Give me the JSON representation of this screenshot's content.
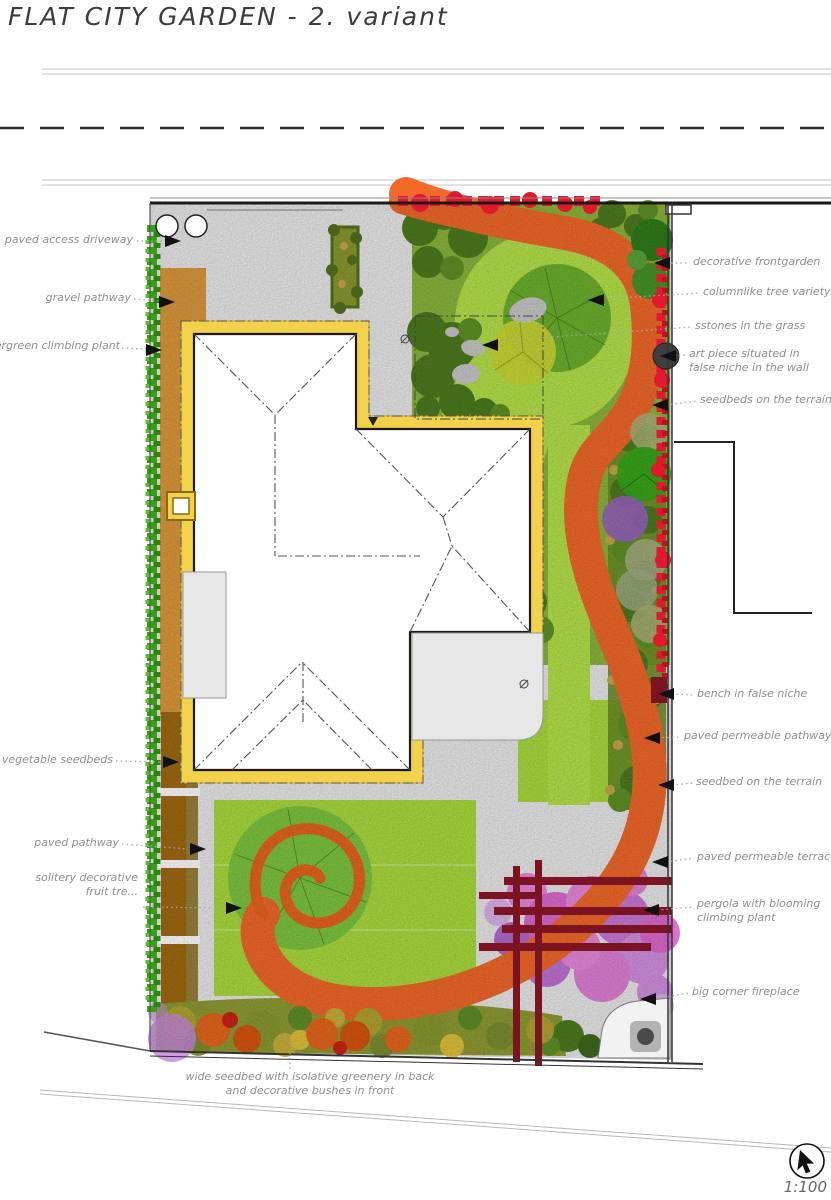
{
  "title": "FLAT CITY GARDEN - 2. variant",
  "scale": "1:100",
  "labels_left": [
    {
      "text": "paved access driveway"
    },
    {
      "text": "gravel pathway"
    },
    {
      "text": "evergreen climbing plant"
    },
    {
      "text": "vegetable seedbeds"
    },
    {
      "text": "paved pathway"
    },
    {
      "line1": "solitery decorative",
      "line2": "fruit tre..."
    }
  ],
  "labels_right": [
    {
      "text": "decorative frontgarden"
    },
    {
      "text": "columnlike tree variety"
    },
    {
      "text": "sstones in the grass"
    },
    {
      "line1": "art piece situated in",
      "line2": "false niche in the wall"
    },
    {
      "text": "seedbeds on the terrain"
    },
    {
      "text": "bench in false niche"
    },
    {
      "text": "paved permeable pathway"
    },
    {
      "text": "seedbed on the terrain"
    },
    {
      "text": "paved permeable terrace"
    },
    {
      "line1": "pergola with blooming",
      "line2": "climbing plant"
    },
    {
      "text": "big corner fireplace"
    }
  ],
  "label_bottom": {
    "line1": "wide seedbed with isolative greenery in back",
    "line2": "and decorative bushes in front"
  },
  "icons": {
    "cursor": "mouse-cursor"
  },
  "colors": {
    "path_orange": "#f2692a",
    "gravel_orange": "#dd9a3e",
    "house_yellow": "#f2d24b",
    "lawn_green": "#abdc3e",
    "bush_green": "#4d7c1f",
    "evergreen": "#35a214",
    "red_foliage": "#e2182e",
    "soil_brown": "#a06a12",
    "pergola_maroon": "#7c1322",
    "bloom_pink": "#e36cd6",
    "paving_gray": "#e9e9e9"
  }
}
